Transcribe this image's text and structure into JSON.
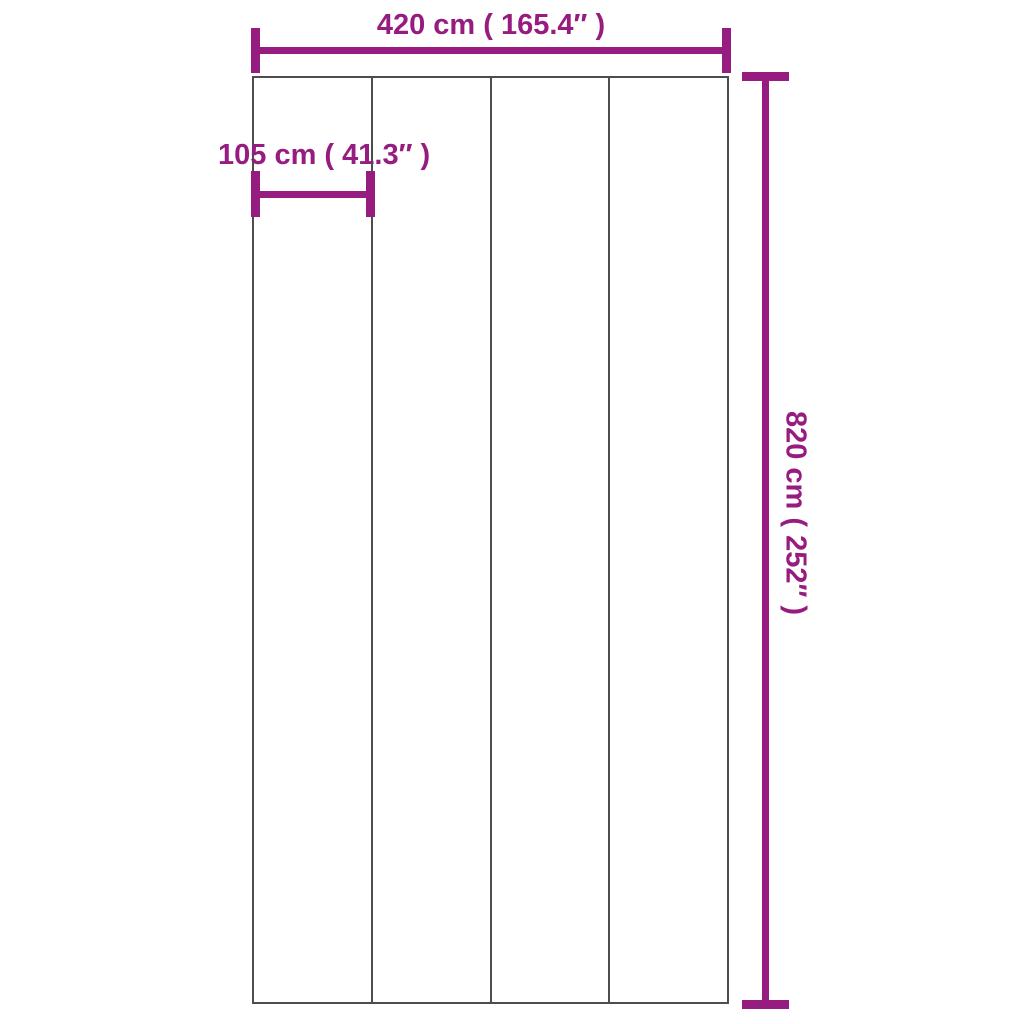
{
  "diagram": {
    "type": "product-dimension-diagram",
    "panel": {
      "sections": 4
    },
    "dimensions": {
      "total_width": {
        "label": "420 cm ( 165.4″ )",
        "value_cm": 420,
        "value_in": 165.4
      },
      "section_width": {
        "label": "105 cm ( 41.3″ )",
        "value_cm": 105,
        "value_in": 41.3
      },
      "total_height": {
        "label": "820 cm ( 252″ )",
        "value_cm": 820,
        "value_in": 252
      }
    },
    "colors": {
      "dimension": "#971C80",
      "outline": "#4D4D4D",
      "background": "#FFFFFF"
    }
  }
}
